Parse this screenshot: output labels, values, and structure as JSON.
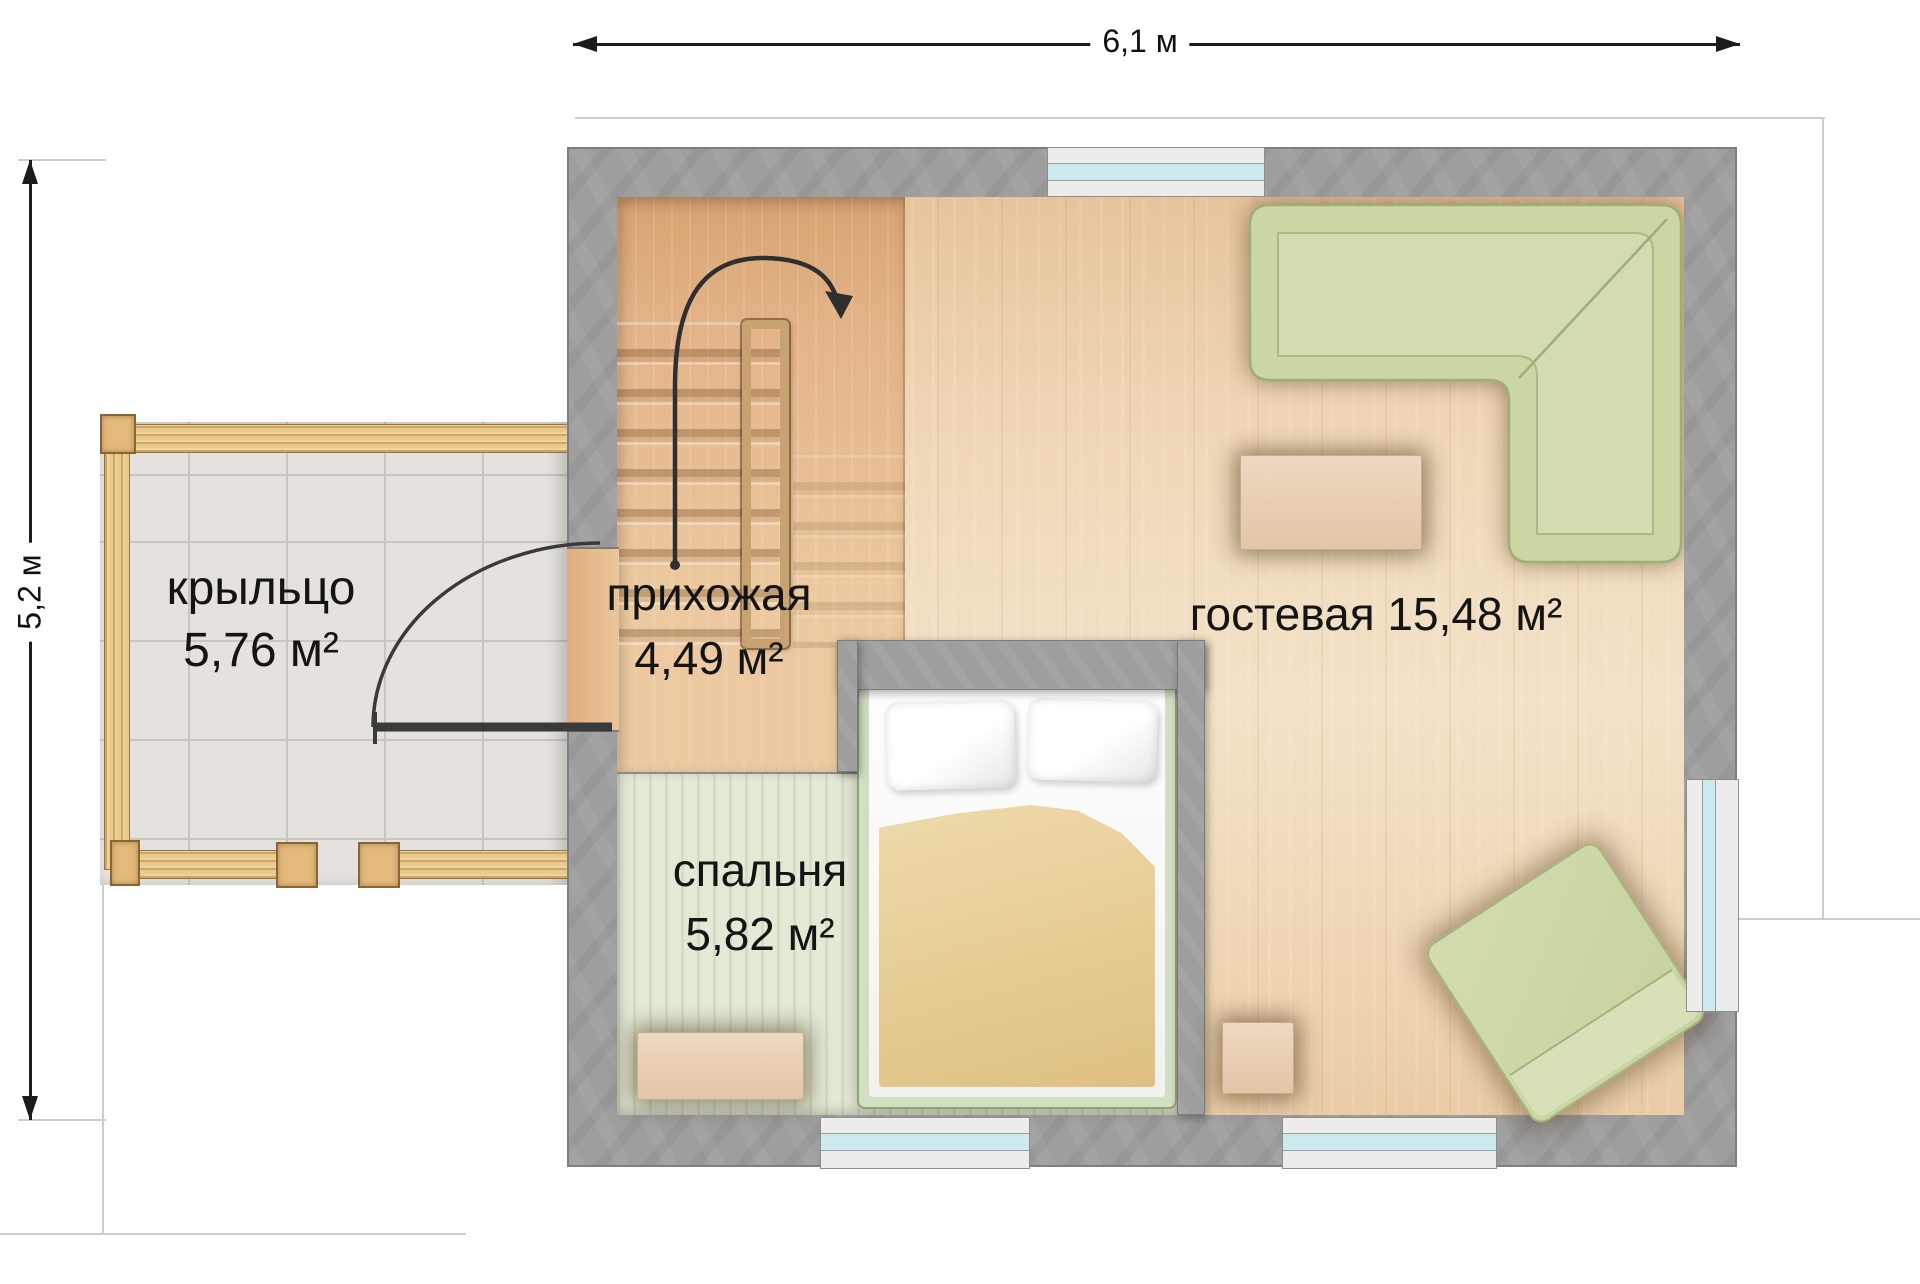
{
  "dimensions": {
    "width": "6,1 м",
    "height": "5,2 м"
  },
  "rooms": {
    "porch": {
      "name": "крыльцо",
      "area": "5,76 м²"
    },
    "hallway": {
      "name": "прихожая",
      "area": "4,49 м²"
    },
    "bedroom": {
      "name": "спальня",
      "area": "5,82 м²"
    },
    "living": {
      "name": "гостевая",
      "area": "15,48 м²"
    }
  },
  "colors": {
    "wall": "#9e9e9e",
    "living_floor": "#eed6b6",
    "hall_floor": "#e2b285",
    "bedroom_floor": "#dde6d0",
    "porch_tile": "#e5e2dd",
    "porch_wood": "#eac98c",
    "sofa_green": "#cbd6a5",
    "blanket_tan": "#e7cf97",
    "window_glass": "#cdeaee"
  }
}
